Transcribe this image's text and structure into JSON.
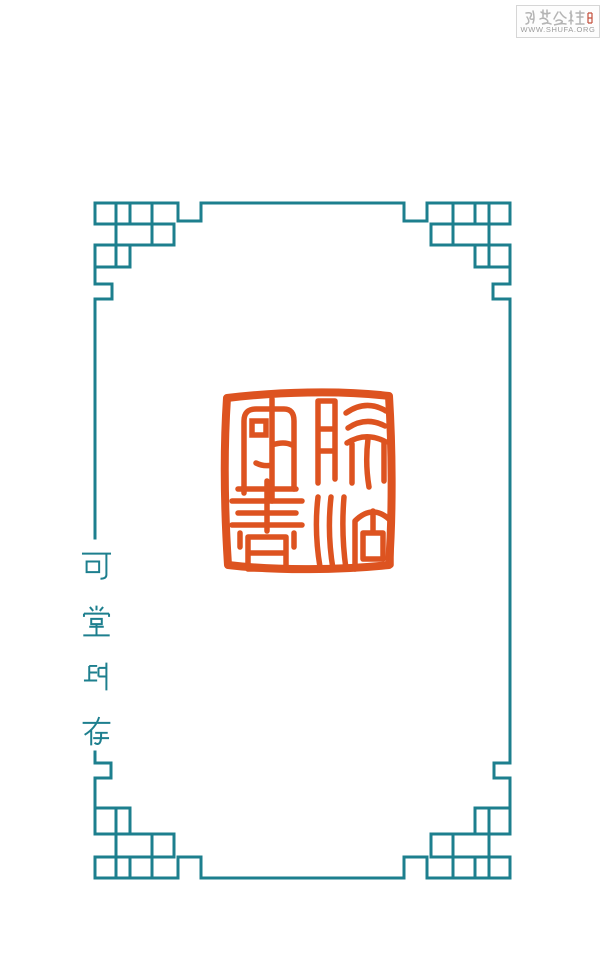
{
  "page": {
    "width": 605,
    "height": 964,
    "background": "#ffffff"
  },
  "watermark": {
    "brand_text": "书艺公社",
    "url_text": "WWW.SHUFA.ORG",
    "box_border_color": "#d6d6d6",
    "text_color": "#b4b4b4",
    "red_mark_color": "#c4503c"
  },
  "frame": {
    "color": "#1d7f8e",
    "pattern": "Chinese fretwork border with interlocking-square corner ornaments"
  },
  "caption": {
    "text": "可堂印存",
    "characters": [
      "可",
      "堂",
      "印",
      "存"
    ],
    "orientation": "vertical, top to bottom, set into the left border line",
    "color": "#1d7f8e"
  },
  "seal": {
    "color": "#dd5320",
    "shape": "square",
    "description": "Vermilion square seal impression, four characters in seal script arranged 2×2; bottom-left character resembles 書"
  }
}
